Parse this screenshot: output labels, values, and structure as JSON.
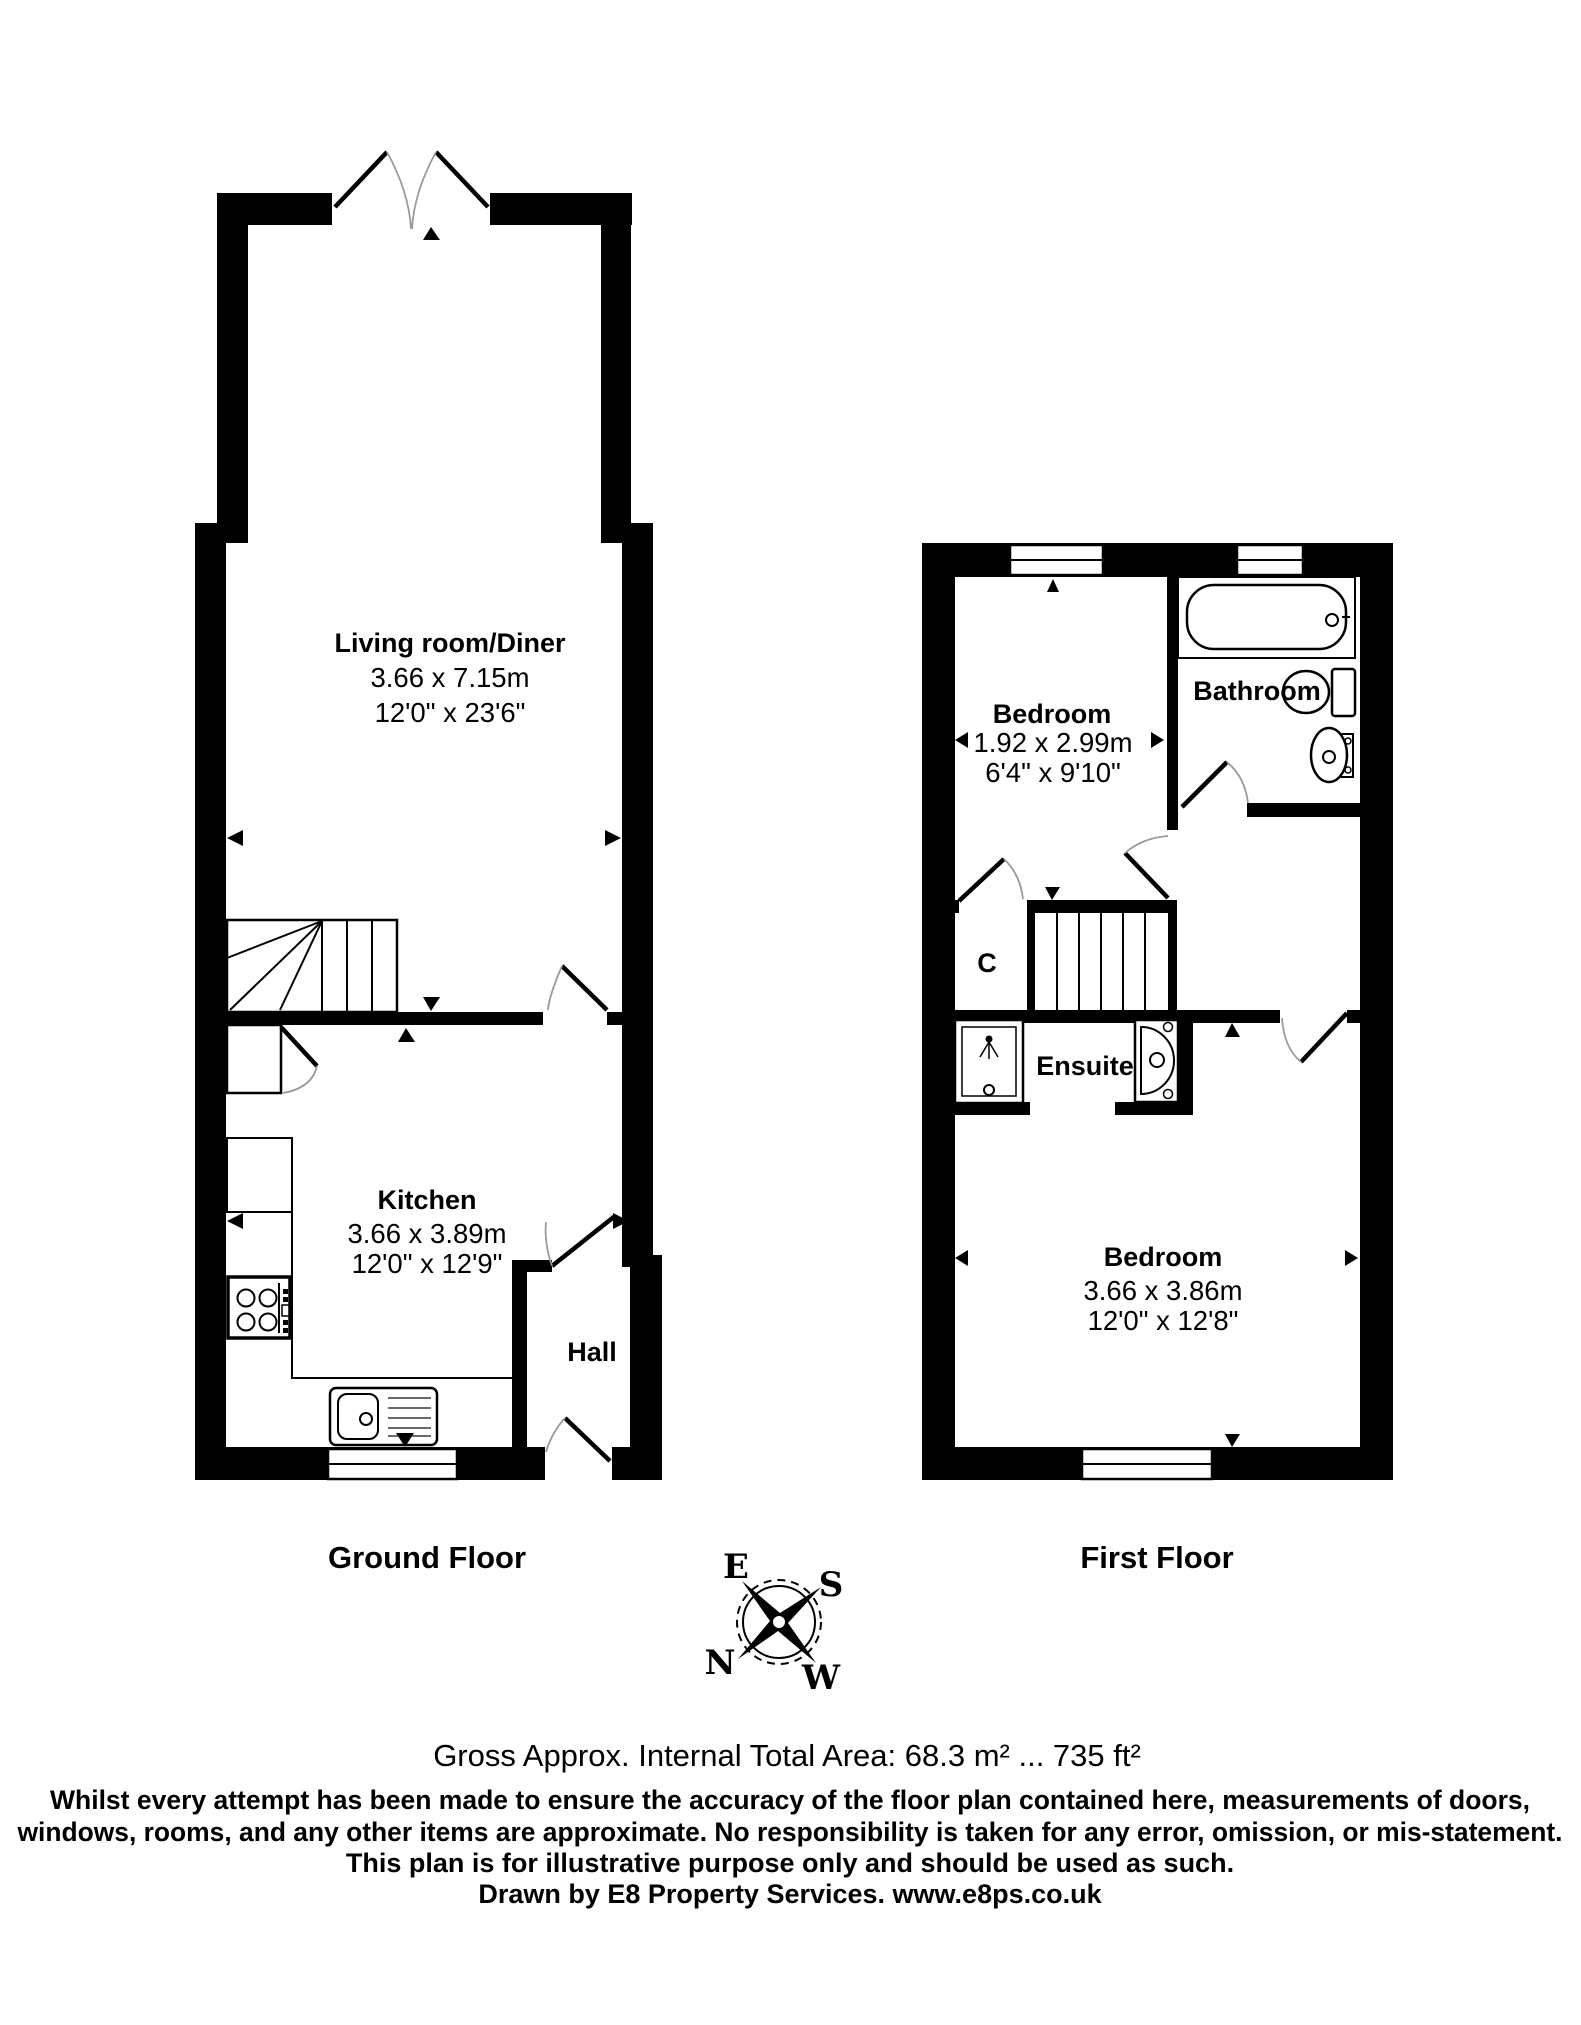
{
  "ground": {
    "label": "Ground Floor",
    "living": {
      "name": "Living room/Diner",
      "metric": "3.66 x 7.15m",
      "imperial": "12'0\" x 23'6\""
    },
    "kitchen": {
      "name": "Kitchen",
      "metric": "3.66 x 3.89m",
      "imperial": "12'0\" x 12'9\""
    },
    "hall": {
      "name": "Hall"
    }
  },
  "first": {
    "label": "First Floor",
    "bedroom_front": {
      "name": "Bedroom",
      "metric": "1.92 x 2.99m",
      "imperial": "6'4\" x 9'10\""
    },
    "bathroom": {
      "name": "Bathroom"
    },
    "cupboard": {
      "name": "C"
    },
    "ensuite": {
      "name": "Ensuite"
    },
    "bedroom_main": {
      "name": "Bedroom",
      "metric": "3.66 x 3.86m",
      "imperial": "12'0\" x 12'8\""
    }
  },
  "compass": {
    "e": "E",
    "s": "S",
    "n": "N",
    "w": "W"
  },
  "footer": {
    "area": "Gross Approx. Internal Total Area: 68.3 m² ... 735 ft²",
    "line1": "Whilst every attempt has been made to ensure the accuracy of the floor plan contained here, measurements of doors,",
    "line2": "windows, rooms, and any other items are approximate. No responsibility is taken for any error, omission, or mis-statement.",
    "line3": "This plan is for illustrative purpose only and should be used as such.",
    "line4": "Drawn by E8 Property Services. www.e8ps.co.uk"
  },
  "colors": {
    "wall": "#000000",
    "bg": "#ffffff",
    "arc": "#9a9a9a"
  }
}
